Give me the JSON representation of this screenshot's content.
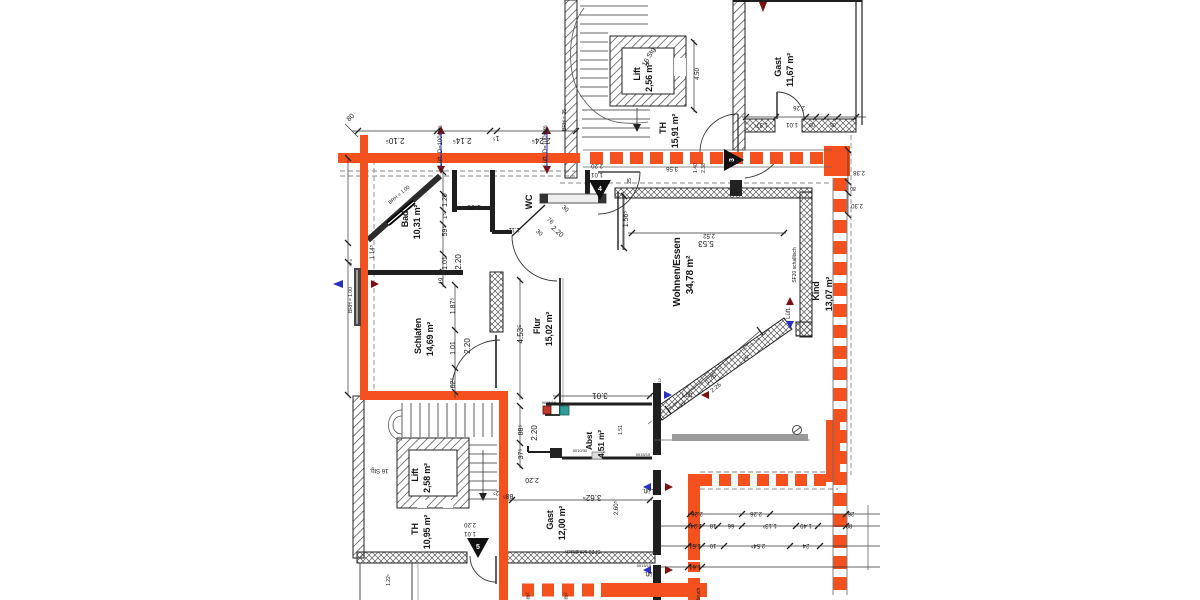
{
  "colors": {
    "ink": "#161616",
    "gray": "#707070",
    "blue": "#2b2fbe",
    "accent": "#f4511e",
    "dark_red": "#7e1010",
    "teal": "#2e9e96",
    "wall": "#1f1f1f"
  },
  "rooms": [
    {
      "name": "Lift",
      "area": "2,56 m²"
    },
    {
      "name": "TH",
      "area": "15,91 m²"
    },
    {
      "name": "Gast",
      "area": "11,67 m²"
    },
    {
      "name": "Bad",
      "area": "10,31 m²"
    },
    {
      "name": "WC",
      "area": ""
    },
    {
      "name": "Schlafen",
      "area": "14,69 m²"
    },
    {
      "name": "Flur",
      "area": "15,02 m²"
    },
    {
      "name": "Wohnen/Essen",
      "area": "34,78 m²"
    },
    {
      "name": "Kind",
      "area": "13,07 m²"
    },
    {
      "name": "Abst",
      "area": "4,51 m²"
    },
    {
      "name": "Gast",
      "area": "12,00 m²"
    },
    {
      "name": "Lift",
      "area": "2,58 m²"
    },
    {
      "name": "TH",
      "area": "10,95 m²"
    }
  ],
  "stairs": {
    "flight_label": "16 Stg."
  },
  "markers": [
    {
      "label": "3"
    },
    {
      "label": "4"
    },
    {
      "label": "5"
    }
  ],
  "annotations": [
    {
      "t": "2.10⁵",
      "x": 395,
      "y": 138,
      "r": 180,
      "s": 8
    },
    {
      "t": "2.14⁵",
      "x": 462,
      "y": 138,
      "r": 180,
      "s": 8
    },
    {
      "t": "1⁵",
      "x": 496,
      "y": 136,
      "r": 180,
      "s": 7
    },
    {
      "t": "2.24⁵",
      "x": 541,
      "y": 138,
      "r": 180,
      "s": 8
    },
    {
      "t": "80",
      "x": 352,
      "y": 119,
      "r": -45,
      "s": 7
    },
    {
      "t": "Lüft. D=100mm",
      "x": 442,
      "y": 146,
      "r": -90,
      "c": "blue",
      "s": 6
    },
    {
      "t": "Lüft. D=100mm",
      "x": 547,
      "y": 146,
      "r": -90,
      "c": "blue",
      "s": 6
    },
    {
      "t": "2.20",
      "x": 597,
      "y": 164,
      "r": 180,
      "s": 6
    },
    {
      "t": "1.01",
      "x": 597,
      "y": 173,
      "r": 180,
      "s": 6
    },
    {
      "t": "3.56",
      "x": 672,
      "y": 167,
      "r": 180,
      "s": 6
    },
    {
      "t": "25",
      "x": 631,
      "y": 181,
      "r": -90,
      "s": 5
    },
    {
      "t": "1.40",
      "x": 697,
      "y": 168,
      "r": -90,
      "s": 5
    },
    {
      "t": "2.38",
      "x": 705,
      "y": 168,
      "r": -90,
      "s": 5
    },
    {
      "t": "4.50",
      "x": 699,
      "y": 74,
      "r": -90,
      "s": 6
    },
    {
      "t": "BRH = 35",
      "x": 566,
      "y": 120,
      "r": -90,
      "c": "gray",
      "s": 5
    },
    {
      "t": "2.52",
      "x": 709,
      "y": 234,
      "r": 180,
      "s": 6
    },
    {
      "t": "2.26",
      "x": 799,
      "y": 106,
      "r": 180,
      "s": 6
    },
    {
      "t": "1.37¹",
      "x": 761,
      "y": 123,
      "r": 180,
      "s": 6
    },
    {
      "t": "1.01",
      "x": 792,
      "y": 123,
      "r": 180,
      "s": 6
    },
    {
      "t": "09",
      "x": 812,
      "y": 123,
      "r": 180,
      "s": 5
    },
    {
      "t": "08",
      "x": 833,
      "y": 123,
      "r": 180,
      "s": 5
    },
    {
      "t": "2.38",
      "x": 859,
      "y": 171,
      "r": 180,
      "s": 6
    },
    {
      "t": "80",
      "x": 853,
      "y": 187,
      "r": 180,
      "s": 5
    },
    {
      "t": "2.30",
      "x": 857,
      "y": 204,
      "r": 180,
      "s": 6
    },
    {
      "t": "BRH = 1.00",
      "x": 400,
      "y": 196,
      "r": -40,
      "c": "gray",
      "s": 5
    },
    {
      "t": "1.20",
      "x": 447,
      "y": 200,
      "r": -90,
      "s": 7
    },
    {
      "t": "1⁵",
      "x": 447,
      "y": 216,
      "r": -90,
      "s": 6
    },
    {
      "t": "59⁵",
      "x": 447,
      "y": 231,
      "r": -90,
      "s": 7
    },
    {
      "t": "1.01",
      "x": 447,
      "y": 263,
      "r": -90,
      "s": 7
    },
    {
      "t": "2.20",
      "x": 461,
      "y": 262,
      "r": -90,
      "s": 8
    },
    {
      "t": "19",
      "x": 443,
      "y": 281,
      "r": -90,
      "s": 6
    },
    {
      "t": "1.00",
      "x": 474,
      "y": 205,
      "r": 180,
      "s": 7
    },
    {
      "t": "1.11⁵",
      "x": 513,
      "y": 228,
      "r": 180,
      "s": 6
    },
    {
      "t": "30",
      "x": 538,
      "y": 234,
      "r": 42,
      "s": 6
    },
    {
      "t": "76",
      "x": 549,
      "y": 222,
      "r": 42,
      "s": 6
    },
    {
      "t": "2.20",
      "x": 556,
      "y": 233,
      "r": 42,
      "s": 7
    },
    {
      "t": "30",
      "x": 564,
      "y": 210,
      "r": 42,
      "s": 6
    },
    {
      "t": "BRH = 1.00",
      "x": 352,
      "y": 300,
      "r": -90,
      "c": "gray",
      "s": 5
    },
    {
      "t": "1.14⁵",
      "x": 374,
      "y": 252,
      "r": -90,
      "s": 6
    },
    {
      "t": "SF4",
      "x": 352,
      "y": 263,
      "r": -90,
      "c": "gray",
      "s": 4
    },
    {
      "t": "1.87⁵",
      "x": 455,
      "y": 306,
      "r": -90,
      "s": 7
    },
    {
      "t": "1.01",
      "x": 455,
      "y": 348,
      "r": -90,
      "s": 7
    },
    {
      "t": "62⁵",
      "x": 455,
      "y": 383,
      "r": -90,
      "s": 7
    },
    {
      "t": "2.20",
      "x": 470,
      "y": 346,
      "r": -90,
      "s": 8
    },
    {
      "t": "4.53⁵",
      "x": 523,
      "y": 334,
      "r": -90,
      "s": 8
    },
    {
      "t": "88⁵",
      "x": 523,
      "y": 430,
      "r": -90,
      "s": 7
    },
    {
      "t": "2.20",
      "x": 537,
      "y": 433,
      "r": -90,
      "s": 8
    },
    {
      "t": "37⁵",
      "x": 523,
      "y": 454,
      "r": -90,
      "s": 7
    },
    {
      "t": "2.20",
      "x": 532,
      "y": 478,
      "r": 180,
      "s": 7
    },
    {
      "t": "88⁵",
      "x": 508,
      "y": 494,
      "r": 180,
      "s": 7
    },
    {
      "t": "2⁵",
      "x": 496,
      "y": 491,
      "r": 180,
      "s": 6
    },
    {
      "t": "3.01",
      "x": 600,
      "y": 393,
      "r": 180,
      "s": 8
    },
    {
      "t": "1.56⁵",
      "x": 628,
      "y": 219,
      "r": -90,
      "s": 7
    },
    {
      "t": "5.53",
      "x": 706,
      "y": 241,
      "r": 180,
      "s": 8
    },
    {
      "t": "SF20 schalltsch",
      "x": 796,
      "y": 265,
      "r": -90,
      "c": "gray",
      "s": 5
    },
    {
      "t": "1.76",
      "x": 712,
      "y": 380,
      "r": -40,
      "s": 6
    },
    {
      "t": "2.26",
      "x": 717,
      "y": 389,
      "r": -40,
      "s": 6
    },
    {
      "t": "25⁶",
      "x": 684,
      "y": 405,
      "r": -40,
      "s": 5
    },
    {
      "t": "25⁶",
      "x": 747,
      "y": 359,
      "r": -40,
      "s": 5
    },
    {
      "t": "SF12",
      "x": 661,
      "y": 383,
      "r": -90,
      "c": "gray",
      "s": 4
    },
    {
      "t": "Lüft.",
      "x": 688,
      "y": 397,
      "c": "blue",
      "s": 6
    },
    {
      "t": "Lüft.",
      "x": 790,
      "y": 313,
      "r": -90,
      "c": "blue",
      "s": 6
    },
    {
      "t": "1.51",
      "x": 622,
      "y": 430,
      "r": -90,
      "s": 5
    },
    {
      "t": "0015/16",
      "x": 549,
      "y": 404,
      "c": "gray",
      "s": 4
    },
    {
      "t": "0010/30",
      "x": 580,
      "y": 452,
      "c": "gray",
      "s": 4
    },
    {
      "t": "0015/15",
      "x": 643,
      "y": 456,
      "c": "gray",
      "s": 4
    },
    {
      "t": "0015/15",
      "x": 644,
      "y": 567,
      "c": "gray",
      "s": 4
    },
    {
      "t": "3.62⁵",
      "x": 592,
      "y": 495,
      "r": 180,
      "s": 8
    },
    {
      "t": "2.60⁵",
      "x": 618,
      "y": 508,
      "r": -90,
      "s": 6
    },
    {
      "t": "SF20 schalltsch",
      "x": 583,
      "y": 550,
      "r": 180,
      "c": "gray",
      "s": 5
    },
    {
      "t": "Lüft.",
      "x": 648,
      "y": 489,
      "r": 180,
      "c": "blue",
      "s": 6
    },
    {
      "t": "Lüft.",
      "x": 650,
      "y": 572,
      "r": 180,
      "c": "blue",
      "s": 6
    },
    {
      "t": "2.20",
      "x": 470,
      "y": 523,
      "r": 180,
      "s": 6
    },
    {
      "t": "1.01",
      "x": 470,
      "y": 532,
      "r": 180,
      "s": 6
    },
    {
      "t": "1.22⁵",
      "x": 390,
      "y": 580,
      "r": -90,
      "s": 5
    },
    {
      "t": "2.26",
      "x": 697,
      "y": 512,
      "r": 180,
      "s": 6
    },
    {
      "t": "2.26",
      "x": 756,
      "y": 512,
      "r": 180,
      "s": 6
    },
    {
      "t": "26",
      "x": 851,
      "y": 512,
      "r": 180,
      "s": 6
    },
    {
      "t": "1.24⁵",
      "x": 695,
      "y": 524,
      "r": 180,
      "s": 6
    },
    {
      "t": "18",
      "x": 713,
      "y": 524,
      "r": 180,
      "s": 6
    },
    {
      "t": "66",
      "x": 731,
      "y": 524,
      "r": 180,
      "s": 6
    },
    {
      "t": "1.13³",
      "x": 770,
      "y": 524,
      "r": 180,
      "s": 6
    },
    {
      "t": "1.49",
      "x": 806,
      "y": 524,
      "r": 180,
      "s": 6
    },
    {
      "t": "88",
      "x": 849,
      "y": 524,
      "r": 180,
      "s": 6
    },
    {
      "t": "1.51",
      "x": 695,
      "y": 544,
      "r": 180,
      "s": 6
    },
    {
      "t": "10",
      "x": 713,
      "y": 544,
      "r": 180,
      "s": 6
    },
    {
      "t": "2.54⁵",
      "x": 758,
      "y": 544,
      "r": 180,
      "s": 6
    },
    {
      "t": "24",
      "x": 806,
      "y": 544,
      "r": 180,
      "s": 6
    },
    {
      "t": "1.61",
      "x": 695,
      "y": 565,
      "r": 180,
      "s": 6
    },
    {
      "t": "m²",
      "x": 530,
      "y": 596,
      "r": -90,
      "c": "accent",
      "s": 6
    },
    {
      "t": "m²",
      "x": 568,
      "y": 596,
      "r": -90,
      "c": "accent",
      "s": 6
    },
    {
      "t": "bruch",
      "x": 700,
      "y": 594,
      "r": -90,
      "c": "accent",
      "s": 5
    }
  ]
}
